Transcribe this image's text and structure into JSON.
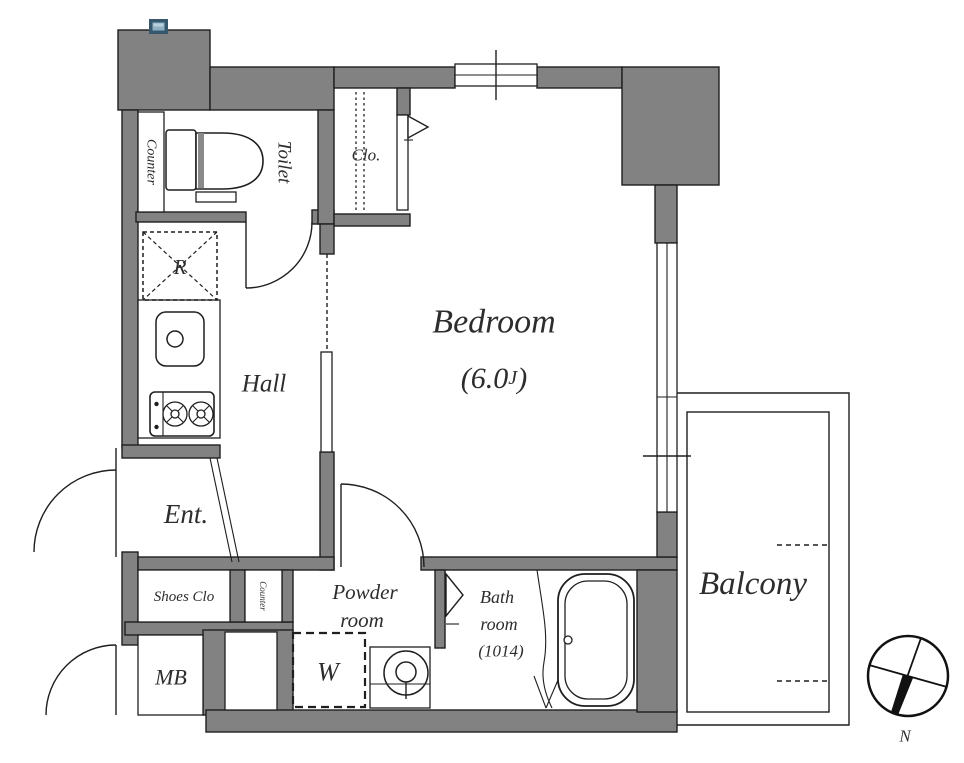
{
  "rooms": {
    "bedroom": {
      "label": "Bedroom",
      "area_open": "(6.0",
      "area_unit": "J",
      "area_close": ")"
    },
    "hall": {
      "label": "Hall"
    },
    "toilet": {
      "label": "Toilet"
    },
    "toilet_counter": {
      "label": "Counter"
    },
    "closet": {
      "label": "Clo."
    },
    "refrigerator_space": {
      "label": "R"
    },
    "entrance": {
      "label": "Ent."
    },
    "shoes_closet": {
      "label": "Shoes Clo"
    },
    "meter_box": {
      "label": "MB"
    },
    "kitchen_counter": {
      "label": "Counter"
    },
    "powder_room": {
      "label_lines": [
        "Powder",
        "room"
      ]
    },
    "washer_space": {
      "label": "W"
    },
    "bathroom": {
      "label_lines": [
        "Bath",
        "room",
        "(1014)"
      ]
    },
    "balcony": {
      "label": "Balcony"
    }
  },
  "compass": {
    "north_label": "N"
  },
  "colors": {
    "wall_fill": "#828282",
    "line": "#1f1f1f",
    "text": "#2d2d2d",
    "marker_border": "#35586c",
    "marker_fill": "#8fb0c3"
  }
}
